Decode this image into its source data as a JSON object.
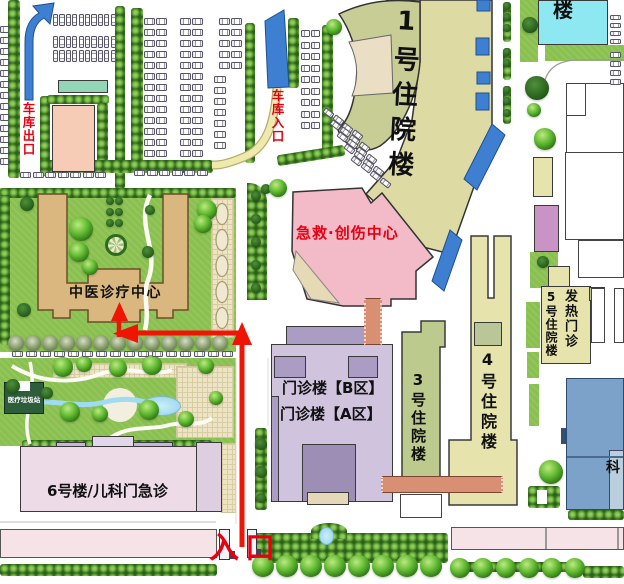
{
  "labels": {
    "garage_exit": "车库出口",
    "garage_entrance": "车库入口",
    "inpatient_1": "1号住院楼",
    "inpatient_2_partial": "楼",
    "emergency_trauma_center": "急救·创伤中心",
    "tcm_center": "中医诊疗中心",
    "outpatient_b": "门诊楼【B区】",
    "outpatient_a": "门诊楼【A区】",
    "inpatient_3": "3号住院楼",
    "inpatient_4": "4号住院楼",
    "inpatient_5": "5号住院楼",
    "fever_clinic": "发热门诊",
    "building_6_pediatrics": "6号楼/儿科门急诊",
    "medical_waste_station": "医疗垃圾站",
    "dept_partial": "科",
    "main_entrance": "入口"
  },
  "colors": {
    "route_red": "#ee1505",
    "label_red": "#e60012",
    "grass": "#8ac04f",
    "hedge": "#55962e",
    "building_beige": "#dedaa4",
    "building_olive": "#c7cd95",
    "emergency_pink": "#f3bac7",
    "tcm_tan": "#d9b77f",
    "outpatient_lavender": "#cfc3de",
    "outpatient_lavender_mid": "#aa9cc2",
    "outpatient_lavender_dark": "#9c8eb4",
    "inpatient3_olive": "#bcca8e",
    "inpatient45_beige": "#e7e3ad",
    "building6_pink": "#eddbe8",
    "building6_tab": "#c6b7d6",
    "cyan_building": "#8de8f2",
    "dept_blue": "#7da2c9",
    "corridor_salmon": "#d98f73",
    "canopy_blue": "#3f7fd1",
    "path_yellow": "#efe9ad",
    "strip_pink": "#f5e3e8",
    "teal_building": "#93d6b7",
    "parking_building_pink": "#f7ccb6",
    "purple_building": "#c993c6",
    "waste_green": "#2e5d3c"
  },
  "icons": {
    "tree": "tree-icon",
    "bush": "bush-icon",
    "parked_car": "car-icon",
    "garage_exit_arrow": "garage-exit-arrow-icon",
    "garage_entrance_ramp": "garage-ramp-icon",
    "entrance_canopy": "canopy-icon",
    "route_arrow": "route-arrow-icon",
    "pond": "pond-icon",
    "flowerbed": "flowerbed-icon",
    "gate_pillar": "gate-pillar-icon"
  }
}
